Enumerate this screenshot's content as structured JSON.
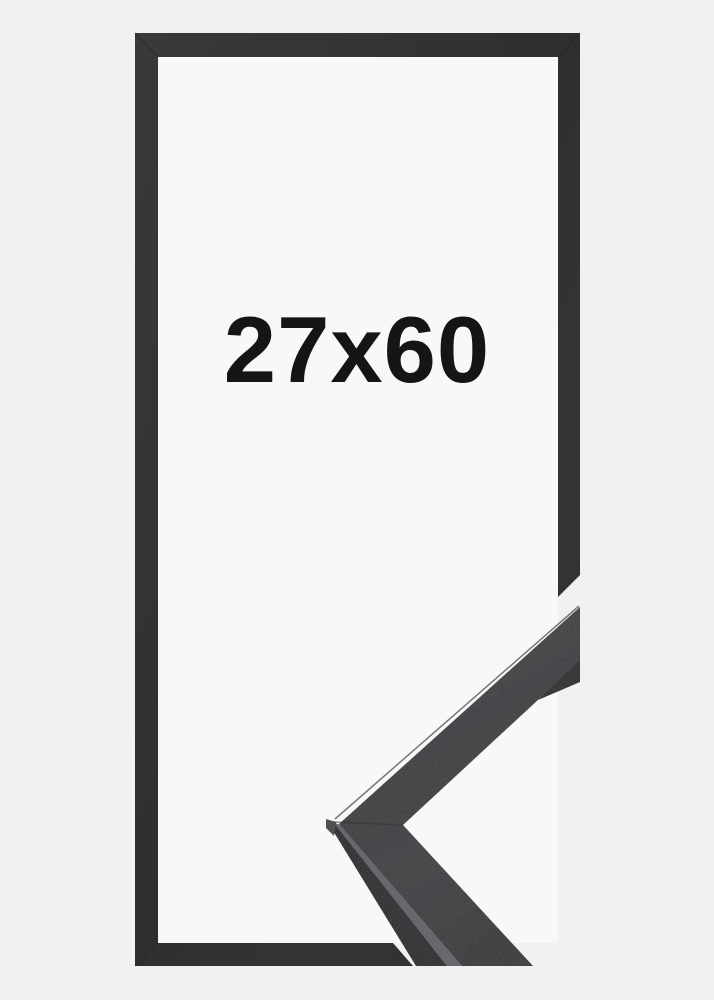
{
  "product_preview": {
    "size_label": "27x60"
  },
  "colors": {
    "background": "#f1f1f2",
    "frame_interior": "#f8f8f9",
    "frame_outline": "#2f2f31",
    "moulding_face": "#37373a",
    "moulding_side": "#232326",
    "moulding_edge_highlight": "#5f5f63",
    "moulding_tip_facet": "#434347",
    "label_text": "#151515"
  }
}
